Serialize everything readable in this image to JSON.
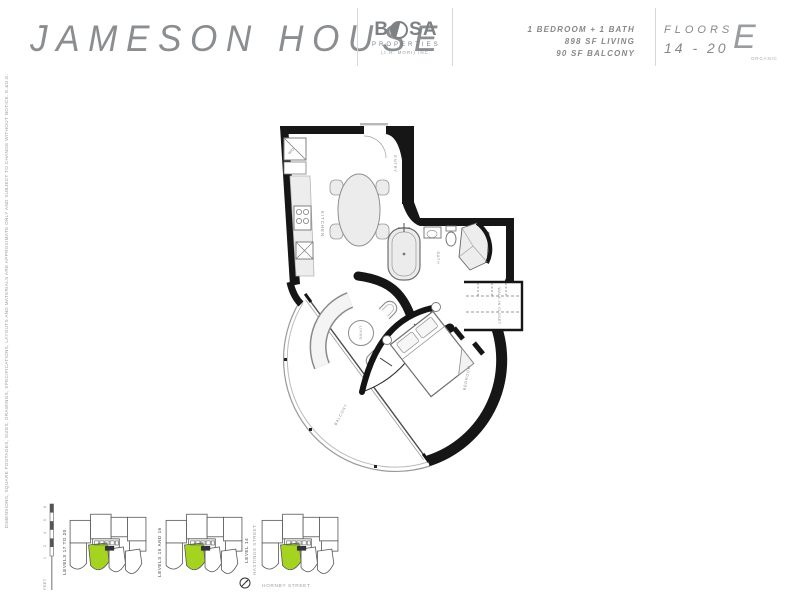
{
  "header": {
    "title": "JAMESON HOUSE",
    "brand": {
      "prefix": "B",
      "suffix": "SA",
      "properties": "PROPERTIES",
      "subtitle": "(J.H. MORI) INC."
    }
  },
  "unit_info": {
    "lines": [
      "1 BEDROOM + 1 BATH",
      "898 SF LIVING",
      "90 SF BALCONY"
    ]
  },
  "floors": {
    "label": "FLOORS",
    "range": "14 - 20"
  },
  "plan_code": {
    "letter": "E",
    "name": "ORGANIC"
  },
  "floor_plan": {
    "rooms": {
      "kitchen": "KITCHEN",
      "entry": "ENTRY",
      "bath": "BATH",
      "walk_in_closet": "WALK-IN CLOSET",
      "living": "LIVING",
      "bedroom": "BEDROOM",
      "balcony": "BALCONY"
    },
    "appliances": {
      "washer_dryer": "W/D"
    }
  },
  "key_plans": {
    "items": [
      {
        "label": "LEVELS 17 TO 20"
      },
      {
        "label": "LEVELS 15 AND 16"
      },
      {
        "label": "LEVEL 14"
      }
    ],
    "street_left": "HASTINGS STREET",
    "street_bottom": "HORNBY STREET"
  },
  "scale_bar": {
    "unit_label": "FEET",
    "ticks": [
      "8",
      "6",
      "4",
      "2",
      "0"
    ]
  },
  "disclaimer": "DIMENSIONS, SQUARE FOOTAGES, SIZES, DRAWINGS, SPECIFICATIONS, LAYOUTS AND MATERIALS ARE APPROXIMATE ONLY AND SUBJECT TO CHANGE WITHOUT NOTICE. E.&O.E.",
  "colors": {
    "accent_green": "#a4d41f",
    "wall_black": "#161616",
    "text_gray": "#8b8e90"
  }
}
